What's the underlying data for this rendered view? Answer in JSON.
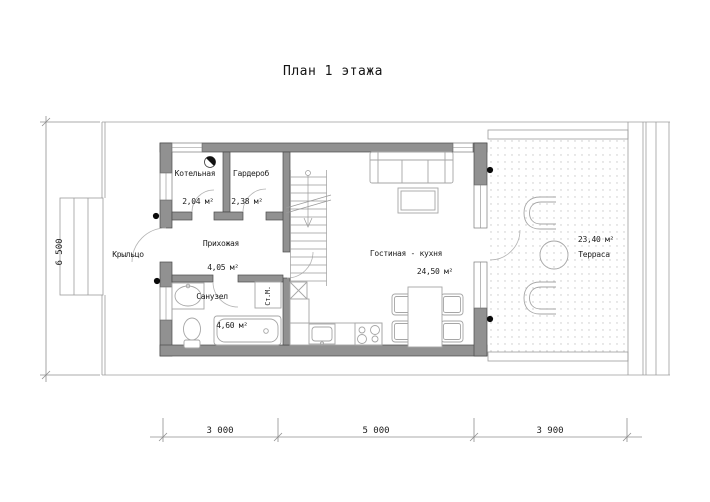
{
  "title": "План 1 этажа",
  "rooms": {
    "boiler_room": {
      "name": "Котельная",
      "area": "2,04 м²"
    },
    "wardrobe": {
      "name": "Гардероб",
      "area": "2,38 м²"
    },
    "hallway": {
      "name": "Прихожая",
      "area": "4,05 м²"
    },
    "bathroom": {
      "name": "Санузел",
      "area": "4,60 м²"
    },
    "living_kitchen": {
      "name": "Гостиная - кухня",
      "area": "24,50 м²"
    },
    "terrace": {
      "name": "Терраса",
      "area": "23,40 м²"
    },
    "porch": {
      "name": "Крыльцо"
    }
  },
  "appliances": {
    "washing_machine": "Ст.М."
  },
  "dimensions": {
    "bottom": [
      "3 000",
      "5 000",
      "3 900"
    ],
    "left": "6 500"
  },
  "colors": {
    "wall_fill": "#919191",
    "wall_edge": "#4a4a4a",
    "thin_line": "#9c9c9c",
    "text": "#1c1c1c",
    "marker": "#0a0a0a"
  }
}
